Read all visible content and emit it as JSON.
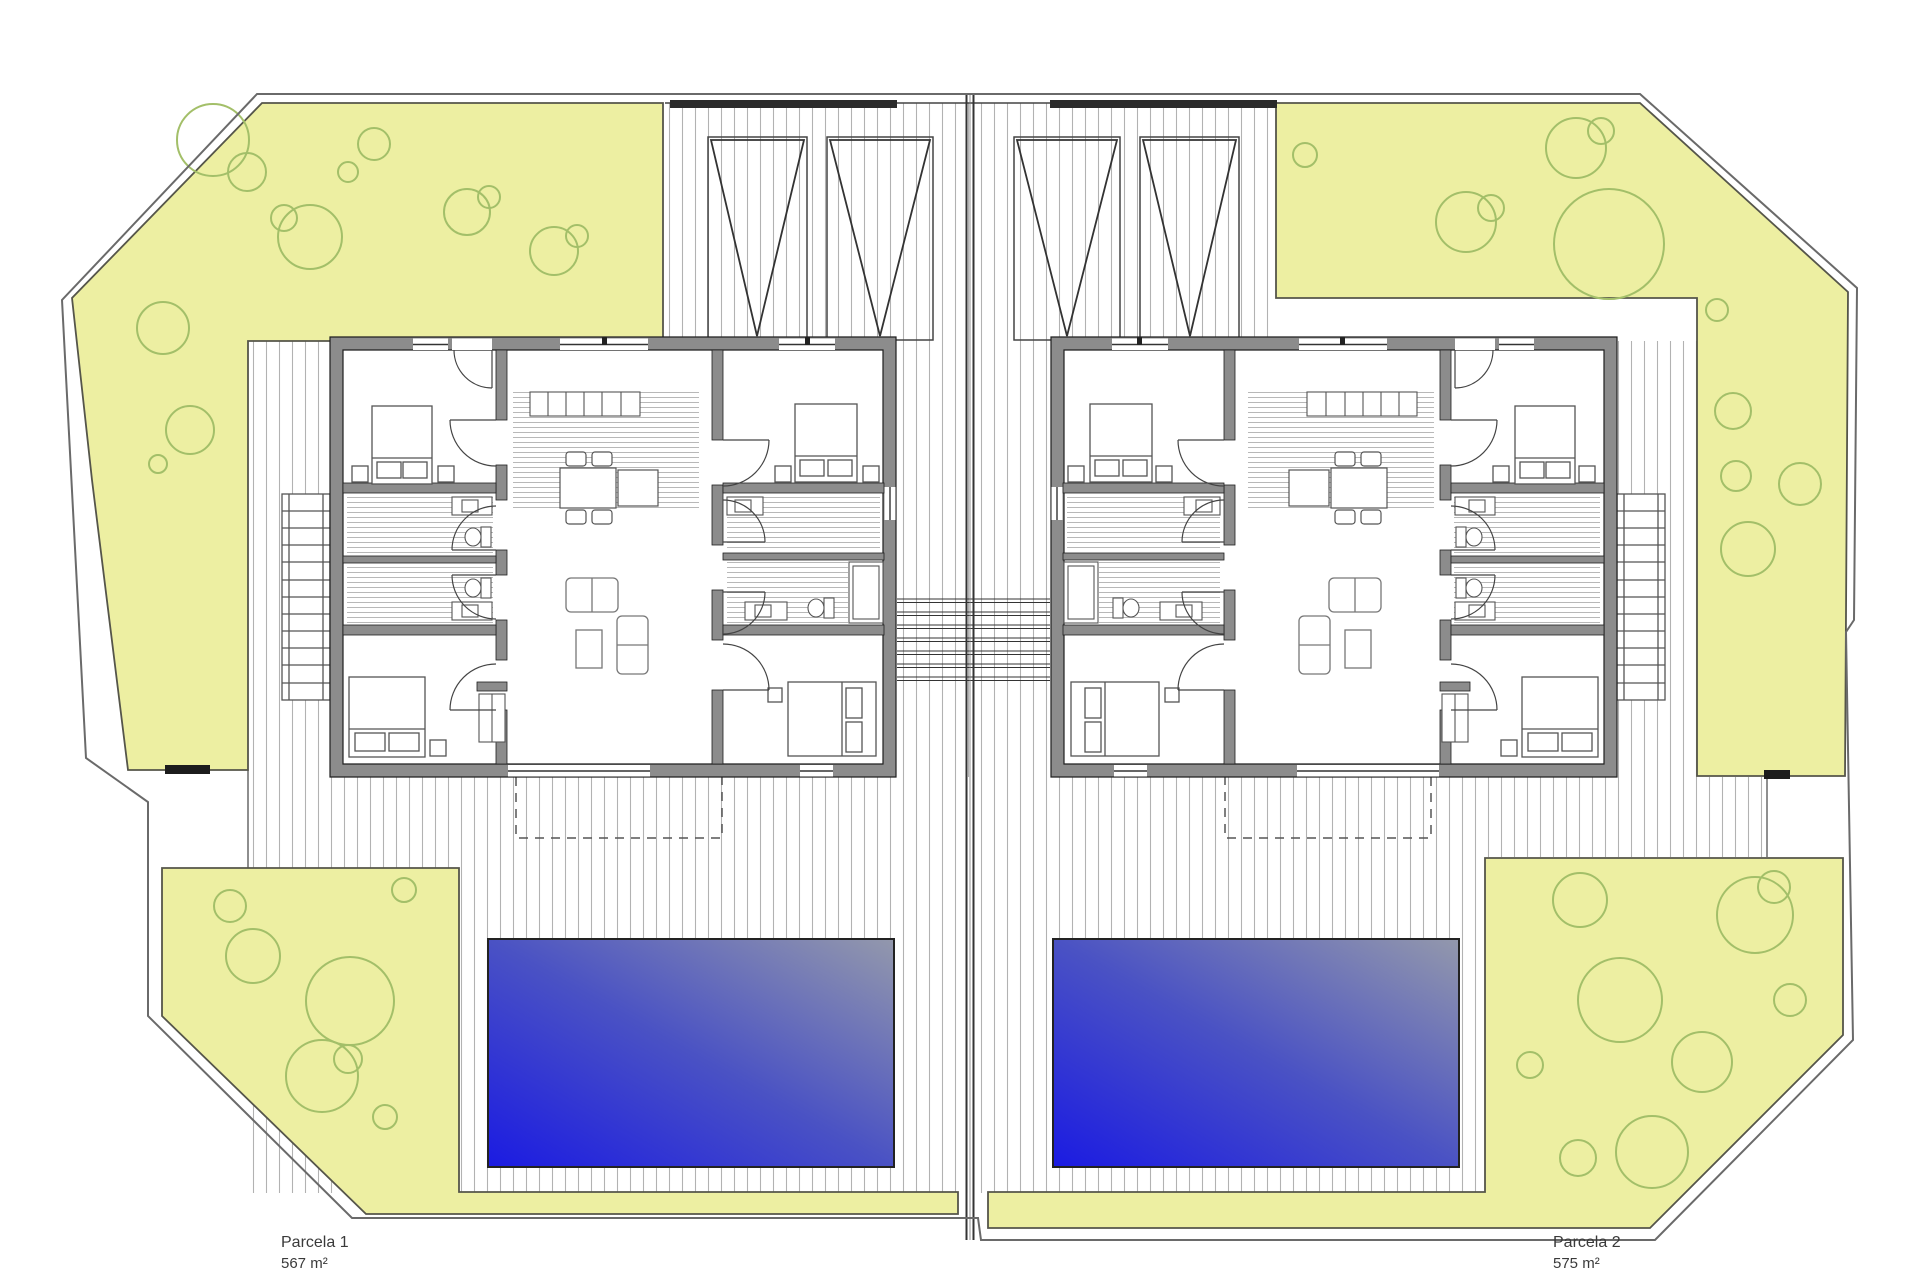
{
  "drawing": {
    "type": "architectural site plan",
    "view": "ground floor top view"
  },
  "parcels": [
    {
      "name": "Parcela 1",
      "area": "567 m²"
    },
    {
      "name": "Parcela 2",
      "area": "575 m²"
    }
  ],
  "site": {
    "houses": 2,
    "pools": 2,
    "pergolas": 4,
    "exterior_staircases": 2
  },
  "colors": {
    "background": "#ffffff",
    "garden_fill": "#edefa2",
    "garden_stroke": "#55554a",
    "tree_stroke": "#a3bf69",
    "wall_fill": "#8c8c8c",
    "wall_edge": "#1f1f1f",
    "deck_hatch_line": "#b2b2b2",
    "pool_deep": "#1b1be2",
    "pool_shallow": "#9398ac",
    "boundary_line": "#6a6a6a",
    "label_text": "#3a3a3a"
  }
}
